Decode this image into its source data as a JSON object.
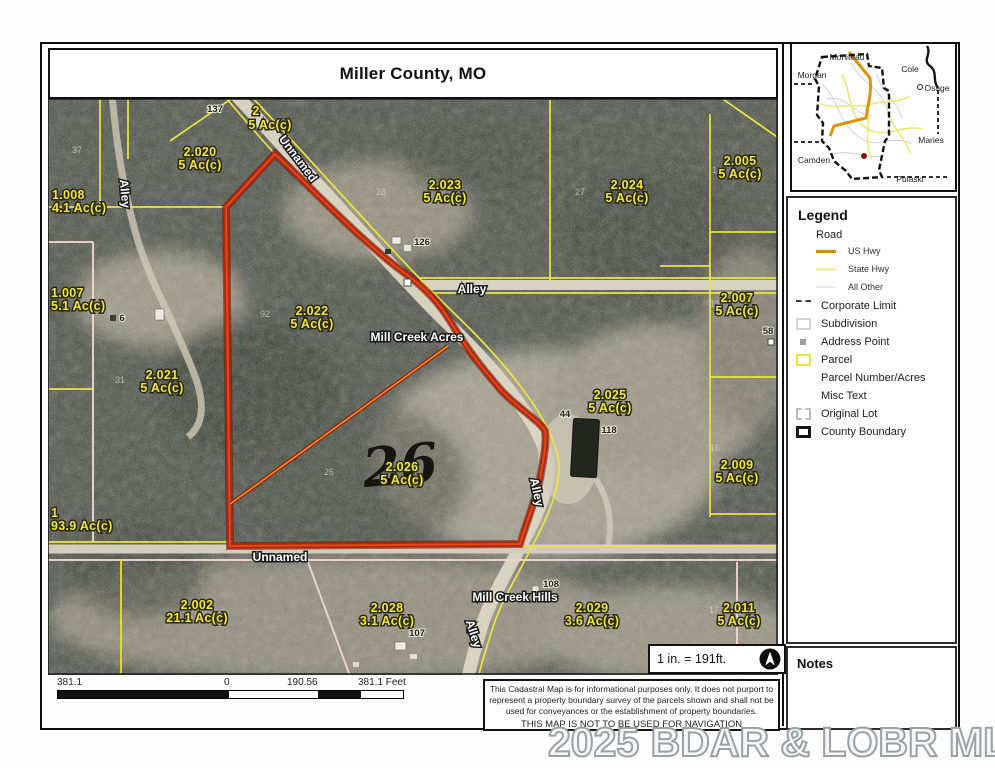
{
  "title": "Miller County, MO",
  "inset": {
    "counties": [
      "Moniteau",
      "Morgan",
      "Cole",
      "Osage",
      "Maries",
      "Camden",
      "Pulaski"
    ]
  },
  "legend": {
    "title": "Legend",
    "road_group": "Road",
    "road_items": [
      "US Hwy",
      "State Hwy",
      "All Other"
    ],
    "items": [
      "Corporate Limit",
      "Subdivision",
      "Address Point",
      "Parcel",
      "Parcel Number/Acres",
      "Misc Text",
      "Original Lot",
      "County Boundary"
    ],
    "parcel_color": "#ede43a",
    "us_hwy_color": "#cd8c05"
  },
  "notes": {
    "title": "Notes"
  },
  "scalebox": {
    "text": "1 in. = 191ft."
  },
  "scalebar": {
    "labels": [
      "381.1",
      "0",
      "190.56",
      "381.1 Feet"
    ]
  },
  "disclaimer": {
    "lines": [
      "This Cadastral Map is for informational purposes only.  It does not purport to",
      "represent a property boundary survey of the parcels shown and shall not be",
      "used for conveyances or the establishment of property boundaries.",
      "THIS MAP IS NOT TO BE USED FOR NAVIGATION"
    ]
  },
  "watermark": "2025 BDAR & LOBR MLS",
  "map": {
    "highlight_color": "#b5260c",
    "parcel_line_color": "#efe33d",
    "parcels": [
      {
        "number": "1.008",
        "acres": "4.1 Ac(c)"
      },
      {
        "number": "2.020",
        "acres": "5 Ac(c)"
      },
      {
        "number": "2",
        "acres": "5 Ac(c)"
      },
      {
        "number": "2.023",
        "acres": "5 Ac(c)"
      },
      {
        "number": "2.024",
        "acres": "5 Ac(c)"
      },
      {
        "number": "2.005",
        "acres": "5 Ac(c)"
      },
      {
        "number": "1.007",
        "acres": "5.1 Ac(c)"
      },
      {
        "number": "2.022",
        "acres": "5 Ac(c)"
      },
      {
        "number": "2.007",
        "acres": "5 Ac(c)"
      },
      {
        "number": "2.021",
        "acres": "5 Ac(c)"
      },
      {
        "number": "2.025",
        "acres": "5 Ac(c)"
      },
      {
        "number": "2.009",
        "acres": "5 Ac(c)"
      },
      {
        "number": "2.026",
        "acres": "5 Ac(c)"
      },
      {
        "number": "1",
        "acres": "93.9 Ac(c)"
      },
      {
        "number": "2.002",
        "acres": "21.1 Ac(c)"
      },
      {
        "number": "2.028",
        "acres": "3.1 Ac(c)"
      },
      {
        "number": "2.029",
        "acres": "3.6 Ac(c)"
      },
      {
        "number": "2.011",
        "acres": "5 Ac(c)"
      }
    ],
    "road_labels": {
      "unnamed_top": "Unnamed",
      "alley_nw": "Alley",
      "alley_east": "Alley",
      "alley_south": "Alley",
      "alley_bottom": "Alley",
      "unnamed_bottom": "Unnamed"
    },
    "subdivision_labels": {
      "acres": "Mill Creek Acres",
      "hills": "Mill Creek Hills"
    },
    "addresses": {
      "a137": "137",
      "a126": "126",
      "a6": "6",
      "a58": "58",
      "a44": "44",
      "a118": "118",
      "a107": "107",
      "a108": "108"
    },
    "lot_numbers": {
      "l37": "37",
      "l92": "92",
      "l28": "28",
      "l27": "27",
      "l31": "31",
      "l14": "14",
      "l13": "13",
      "l16": "16",
      "l17": "17",
      "l26": "26"
    },
    "highlighted_lot": "26"
  }
}
